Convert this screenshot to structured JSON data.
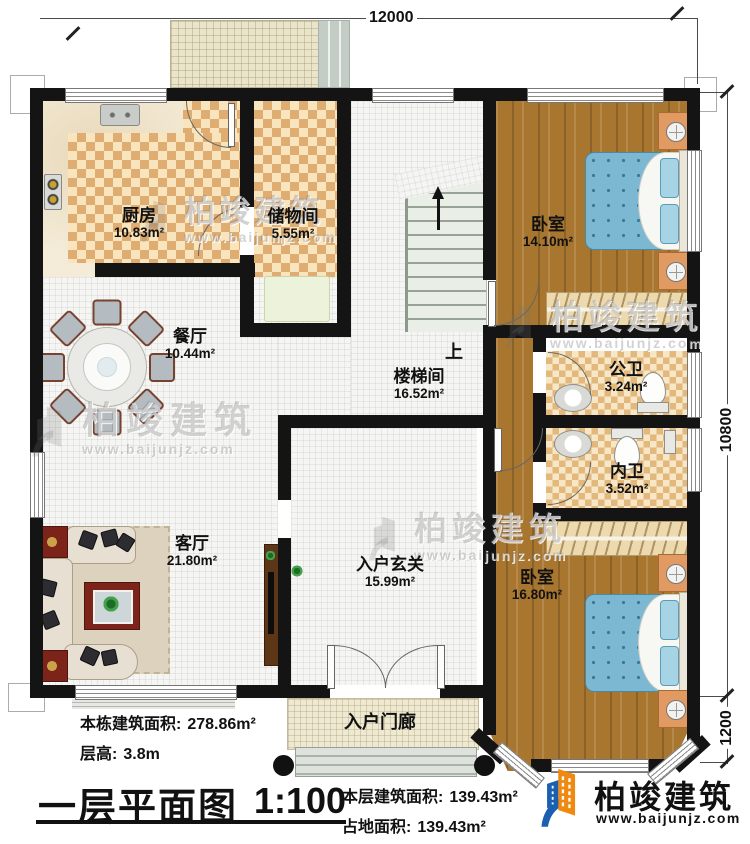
{
  "plan": {
    "dim_top": "12000",
    "dim_right_main": "10800",
    "dim_right_bay": "1200",
    "stairs_up": "上",
    "rooms": {
      "kitchen": {
        "name": "厨房",
        "area": "10.83m²"
      },
      "storage": {
        "name": "储物间",
        "area": "5.55m²"
      },
      "bedroom_top": {
        "name": "卧室",
        "area": "14.10m²"
      },
      "dining": {
        "name": "餐厅",
        "area": "10.44m²"
      },
      "stairwell": {
        "name": "楼梯间",
        "area": "16.52m²"
      },
      "bath_public": {
        "name": "公卫",
        "area": "3.24m²"
      },
      "bath_inner": {
        "name": "内卫",
        "area": "3.52m²"
      },
      "living": {
        "name": "客厅",
        "area": "21.80m²"
      },
      "foyer": {
        "name": "入户玄关",
        "area": "15.99m²"
      },
      "bedroom_bottom": {
        "name": "卧室",
        "area": "16.80m²"
      },
      "porch": {
        "name": "入户门廊"
      }
    }
  },
  "titleblock": {
    "building_area_label": "本栋建筑面积:",
    "building_area_value": "278.86m²",
    "floor_height_label": "层高:",
    "floor_height_value": "3.8m",
    "title": "一层平面图",
    "scale": "1:100",
    "floor_area_label": "本层建筑面积:",
    "floor_area_value": "139.43m²",
    "footprint_label": "占地面积:",
    "footprint_value": "139.43m²"
  },
  "brand": {
    "name": "柏竣建筑",
    "url": "www.baijunjz.com"
  },
  "watermark": {
    "name": "柏竣建筑",
    "url": "www.baijunjz.com"
  },
  "colors": {
    "brand_blue": "#1a5fb0",
    "brand_orange": "#f0890f",
    "wall": "#141414"
  }
}
